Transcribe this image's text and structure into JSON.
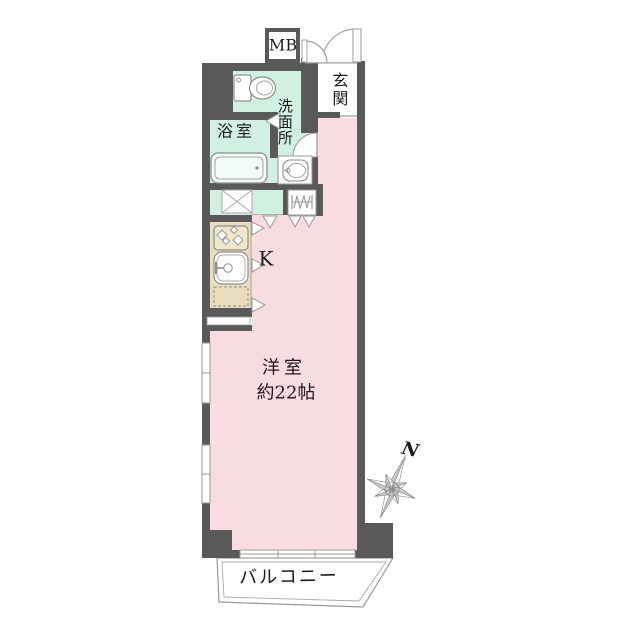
{
  "floor_plan": {
    "type": "apartment-floor-plan",
    "rooms": {
      "meter_box": {
        "label": "MB"
      },
      "entrance": {
        "label": "玄関"
      },
      "washroom": {
        "label": "洗面所"
      },
      "bathroom": {
        "label": "浴室"
      },
      "kitchen": {
        "label": "K"
      },
      "main_room": {
        "label": "洋室",
        "size_label": "約22帖"
      },
      "balcony": {
        "label": "バルコニー"
      }
    },
    "compass": {
      "north_label": "N"
    },
    "colors": {
      "wall": "#595959",
      "room_pink": "#f9dbe2",
      "wet_area_mint": "#d0f0e1",
      "kitchen_beige": "#eaddbc",
      "line_gray": "#999999",
      "fixture_gray": "#8e8e8e",
      "text": "#1b1b1b"
    }
  }
}
